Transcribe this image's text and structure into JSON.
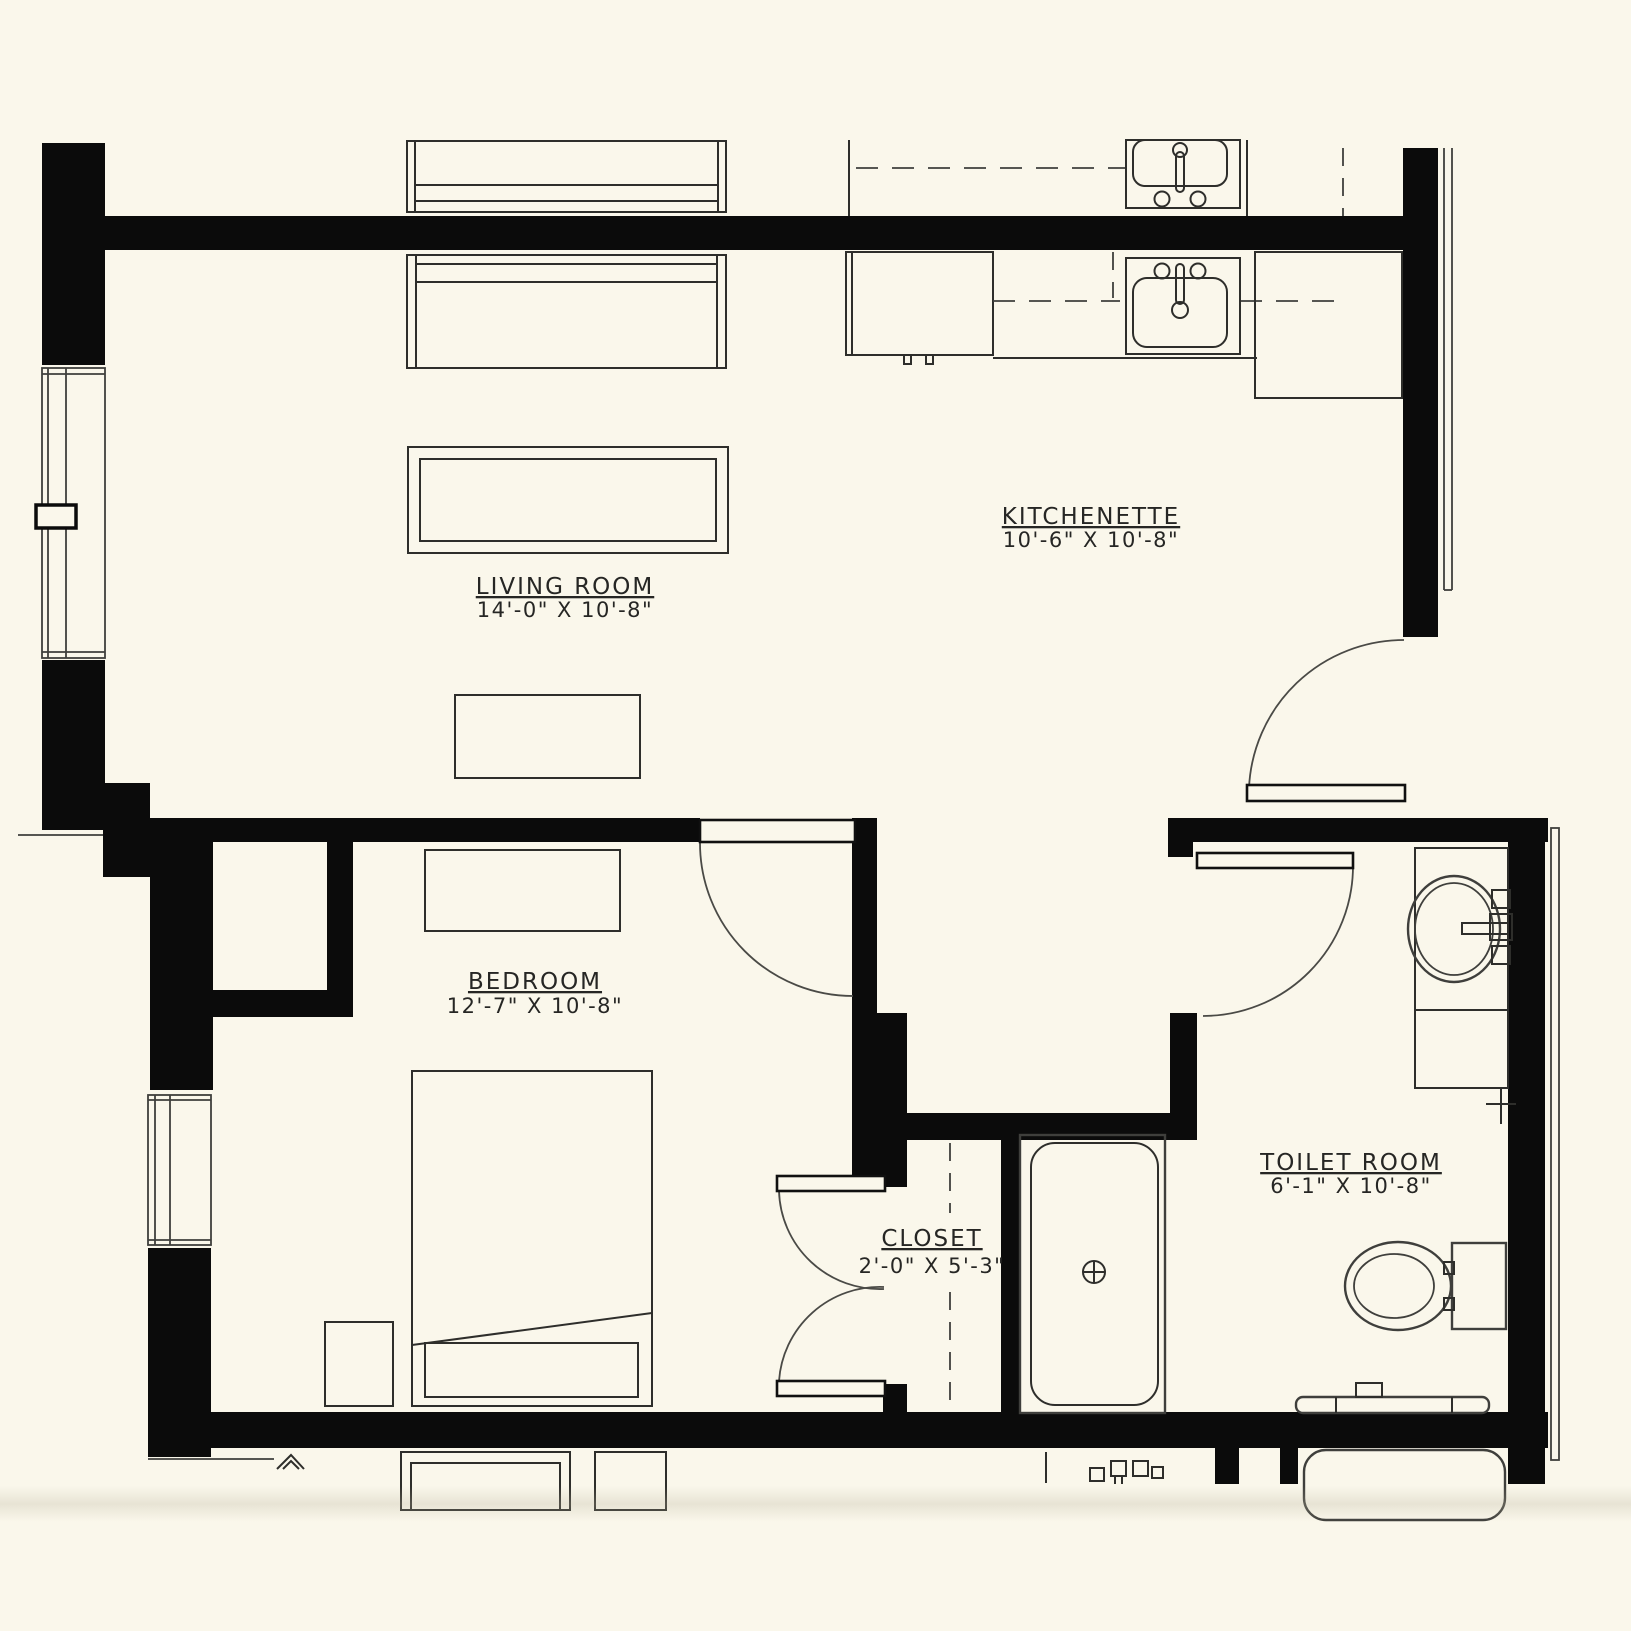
{
  "drawing": {
    "type": "apartment floor plan",
    "background_color": "#FAF7EB",
    "wall_color": "#0B0B0B",
    "line_color": "#3F3F3C",
    "text_color": "#262624"
  },
  "rooms": {
    "living_room": {
      "name": "LIVING ROOM",
      "dims": "14'-0\" X 10'-8\""
    },
    "kitchenette": {
      "name": "KITCHENETTE",
      "dims": "10'-6\" X 10'-8\""
    },
    "bedroom": {
      "name": "BEDROOM",
      "dims": "12'-7\" X 10'-8\""
    },
    "closet": {
      "name": "CLOSET",
      "dims": "2'-0\" X 5'-3\""
    },
    "toilet_room": {
      "name": "TOILET ROOM",
      "dims": "6'-1\" X 10'-8\""
    }
  },
  "fixtures": [
    "bookshelf",
    "sofa",
    "coffee-table",
    "tv-console",
    "kitchen-sink",
    "dishwasher",
    "refrigerator",
    "bed",
    "nightstand",
    "dresser",
    "closet-double-doors",
    "closet-rod-dashed",
    "shower",
    "vanity-sink",
    "vanity-cabinet",
    "toilet",
    "grab-bar",
    "bathtub",
    "entry-door",
    "bedroom-door",
    "toilet-room-door",
    "living-room-window",
    "bedroom-window"
  ]
}
